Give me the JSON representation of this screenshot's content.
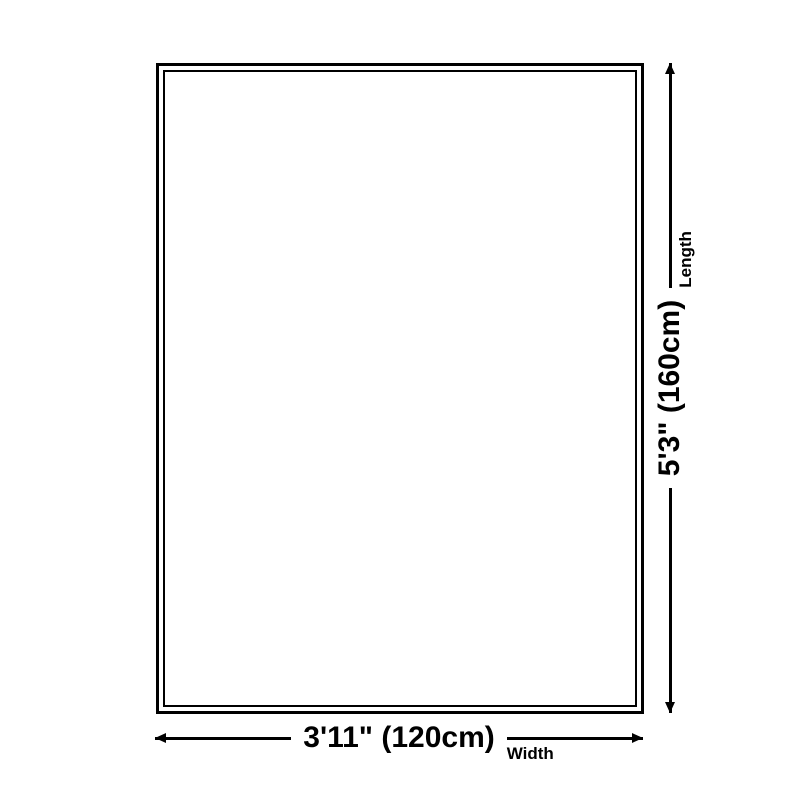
{
  "diagram": {
    "type": "product-size-diagram",
    "product_outline": {
      "style": "double-border-rectangle",
      "border_color": "#000000",
      "fill_color": "#ffffff"
    },
    "length_dimension": {
      "value": "5'3\" (160cm)",
      "axis_label": "Length",
      "orientation": "vertical",
      "arrow": "double-headed"
    },
    "width_dimension": {
      "value": "3'11\" (120cm)",
      "axis_label": "Width",
      "orientation": "horizontal",
      "arrow": "double-headed"
    },
    "colors": {
      "line": "#000000",
      "text": "#000000",
      "background": "#ffffff"
    }
  }
}
